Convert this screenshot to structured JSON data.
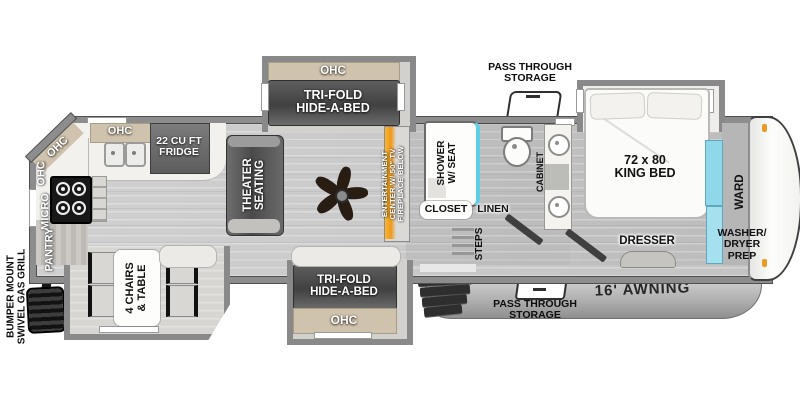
{
  "exterior": {
    "grill": [
      "BUMPER MOUNT",
      "SWIVEL GAS GRILL"
    ],
    "pass_through_top": [
      "PASS THROUGH",
      "STORAGE"
    ],
    "pass_through_bottom": [
      "PASS THROUGH",
      "STORAGE"
    ],
    "awning": "16' AWNING"
  },
  "kitchen": {
    "ohc_corner": "OHC",
    "ohc_left": "OHC",
    "micro": "MICRO",
    "pantry": "PANTRY",
    "ohc_top": "OHC",
    "fridge": [
      "22 CU FT",
      "FRIDGE"
    ]
  },
  "dinette": {
    "label": [
      "4 CHAIRS",
      "& TABLE"
    ]
  },
  "living": {
    "theater": [
      "THEATER",
      "SEATING"
    ],
    "top_slide_ohc": "OHC",
    "top_slide_bed": [
      "TRI-FOLD",
      "HIDE-A-BED"
    ],
    "bottom_slide_bed": [
      "TRI-FOLD",
      "HIDE-A-BED"
    ],
    "bottom_slide_ohc": "OHC",
    "entertainment": [
      "ENTERTAINMENT",
      "CENTER W/ 50\" TV",
      "FIREPLACE BELOW"
    ]
  },
  "bathroom": {
    "shower": [
      "SHOWER",
      "W/ SEAT"
    ],
    "closet": "CLOSET",
    "linen": "LINEN",
    "steps": "STEPS",
    "cabinet": "CABINET"
  },
  "bedroom": {
    "bed": [
      "72 x 80",
      "KING BED"
    ],
    "dresser": "DRESSER",
    "ward": "WARD",
    "washer": [
      "WASHER/",
      "DRYER",
      "PREP"
    ]
  },
  "colors": {
    "wall": "#8d8d8d",
    "floor": "#c9c9c9",
    "counter": "#f2f1ed",
    "cabinet_tan": "#cfc3ad",
    "dark_furniture": "#4a4a4a",
    "accent_teal": "#5fd0e8",
    "accent_orange": "#f09819",
    "awning": "#b5b5b5",
    "marker_light": "#e89c28"
  }
}
